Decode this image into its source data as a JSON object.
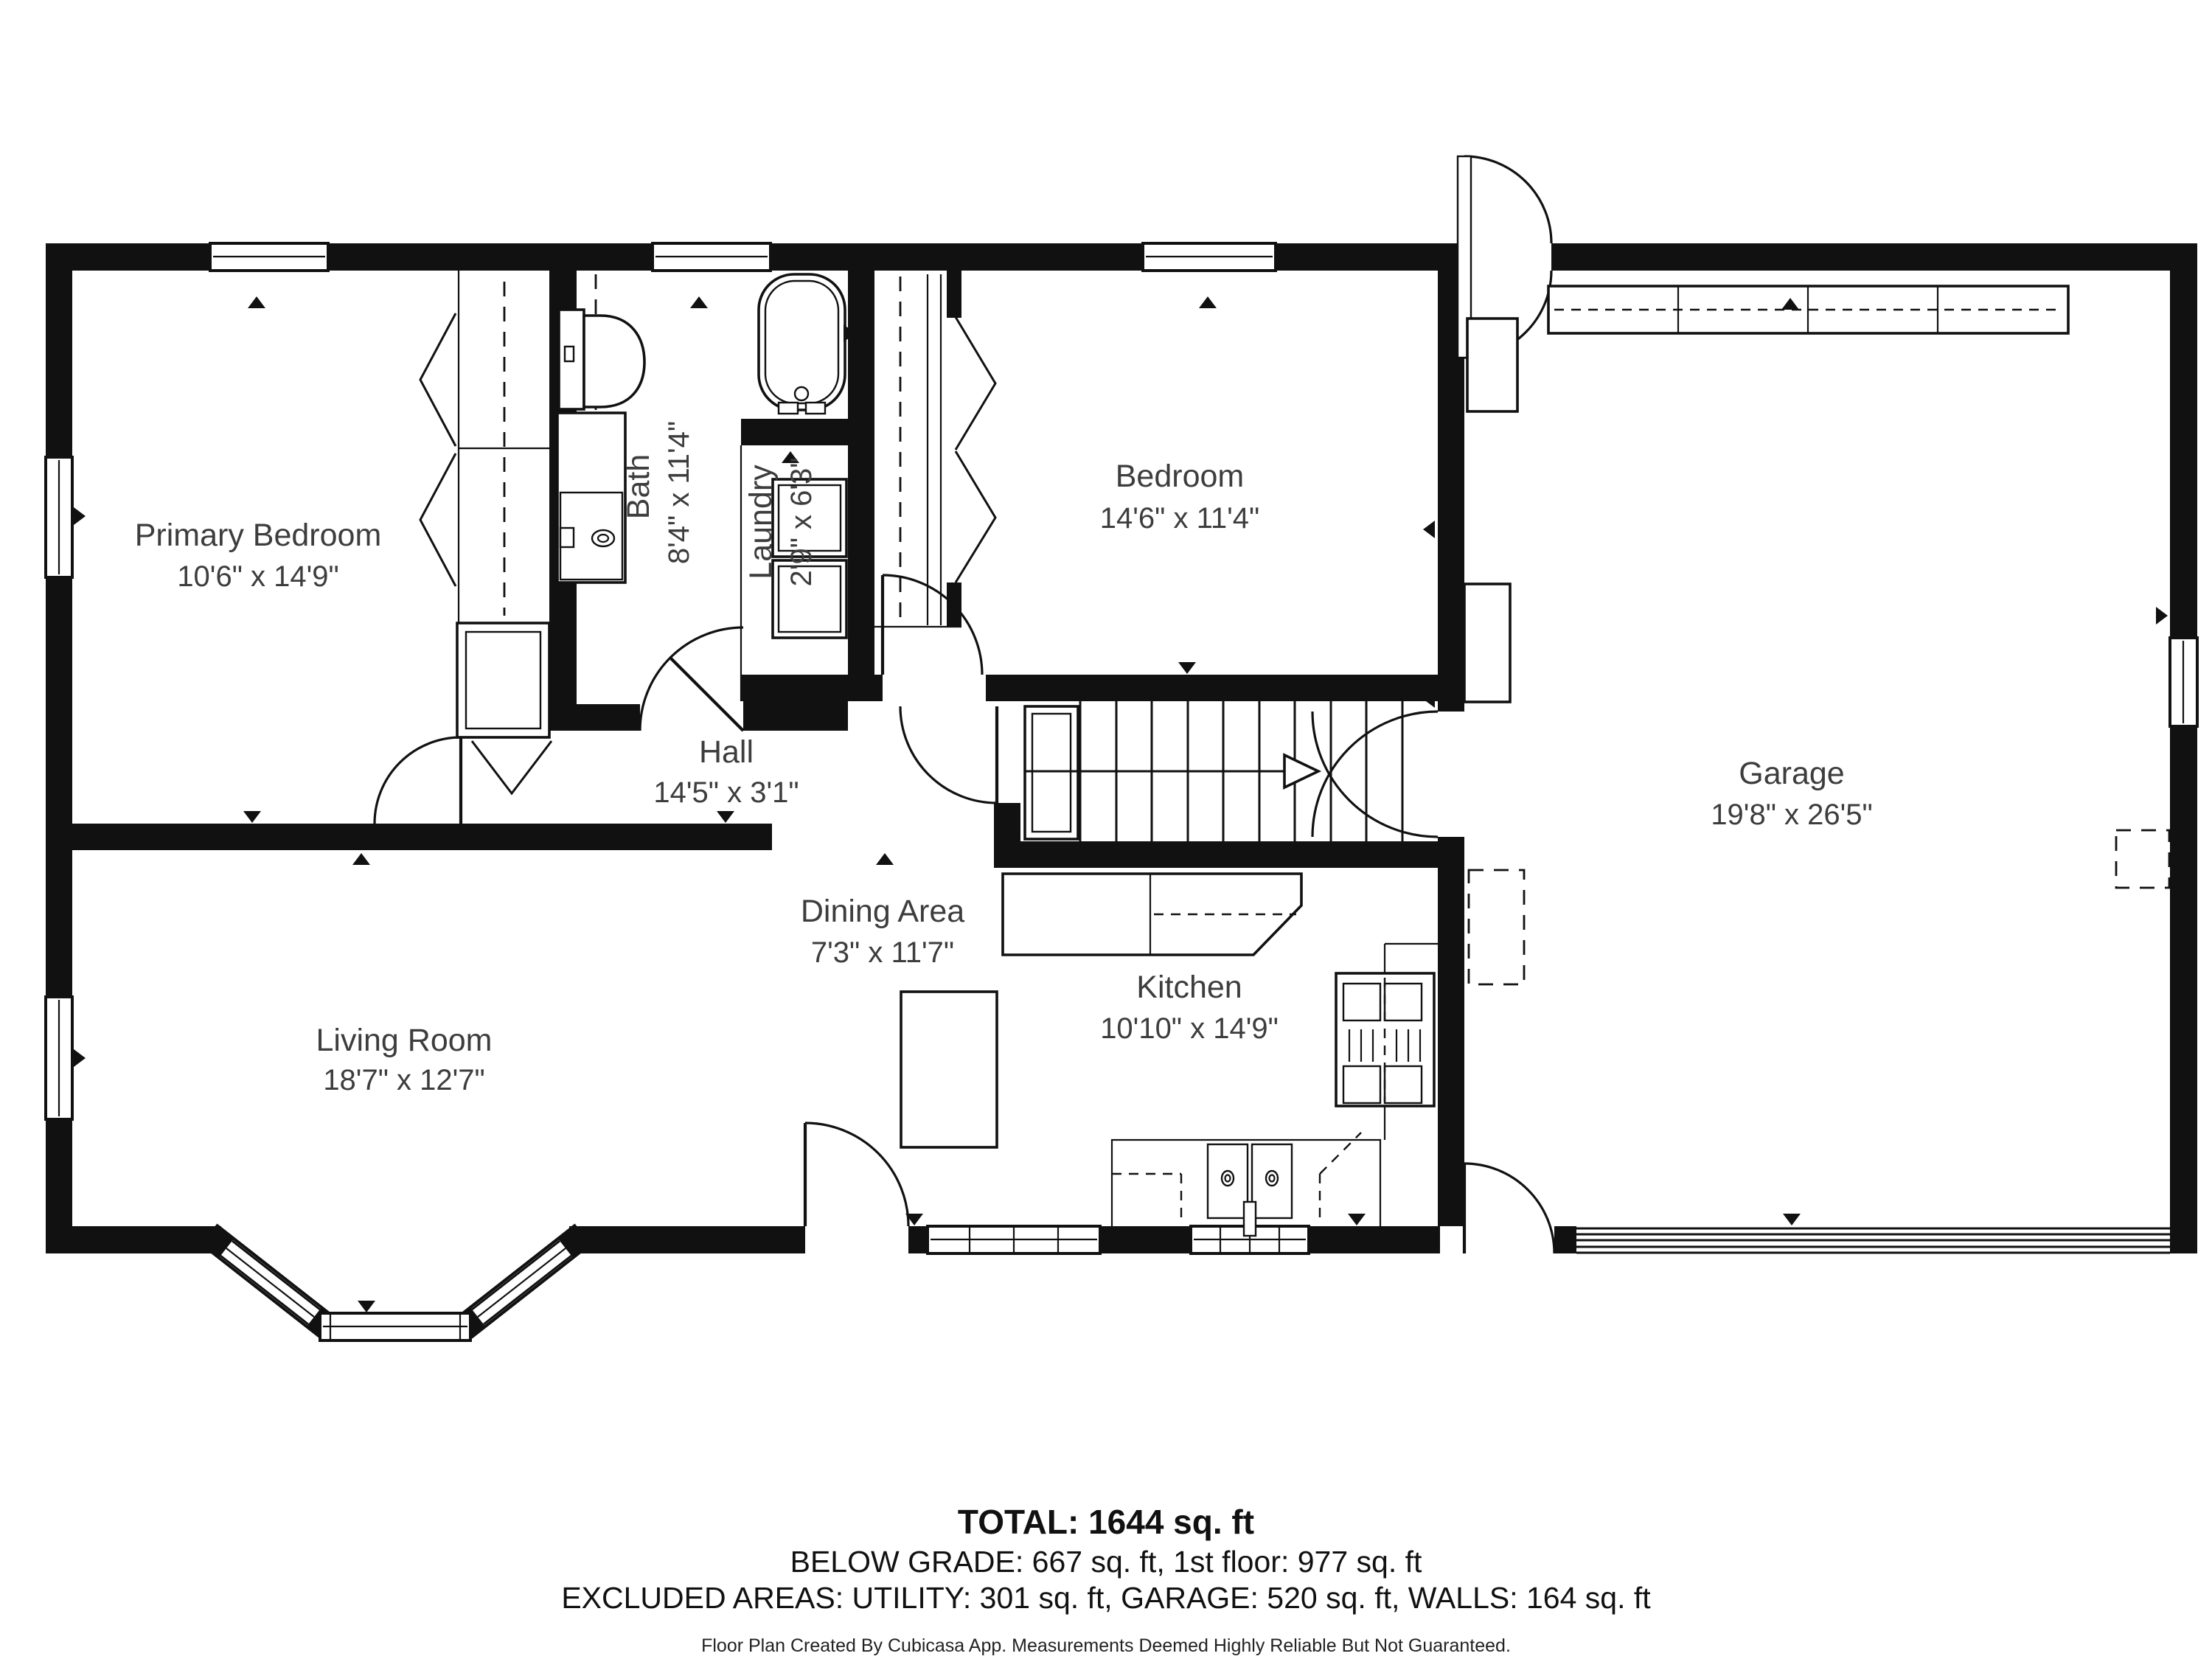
{
  "rooms": [
    {
      "name": "Primary Bedroom",
      "dims": "10'6\" x 14'9\""
    },
    {
      "name": "Bath",
      "dims": "8'4\" x 11'4\""
    },
    {
      "name": "Laundry",
      "dims": "2'9\" x 6'3\""
    },
    {
      "name": "Bedroom",
      "dims": "14'6\" x 11'4\""
    },
    {
      "name": "Hall",
      "dims": "14'5\" x 3'1\""
    },
    {
      "name": "Dining Area",
      "dims": "7'3\" x 11'7\""
    },
    {
      "name": "Living Room",
      "dims": "18'7\" x 12'7\""
    },
    {
      "name": "Kitchen",
      "dims": "10'10\" x 14'9\""
    },
    {
      "name": "Garage",
      "dims": "19'8\" x 26'5\""
    }
  ],
  "summary": {
    "total": "TOTAL: 1644 sq. ft",
    "grade_line": "BELOW GRADE: 667 sq. ft, 1st floor: 977 sq. ft",
    "excluded_line": "EXCLUDED AREAS: UTILITY: 301 sq. ft, GARAGE: 520 sq. ft, WALLS: 164 sq. ft"
  },
  "footer": "Floor Plan Created By Cubicasa App. Measurements Deemed Highly Reliable But Not Guaranteed.",
  "colors": {
    "wall": "#111111",
    "room_label": "#3d3d3d",
    "summary_text": "#111111",
    "background": "#ffffff"
  }
}
